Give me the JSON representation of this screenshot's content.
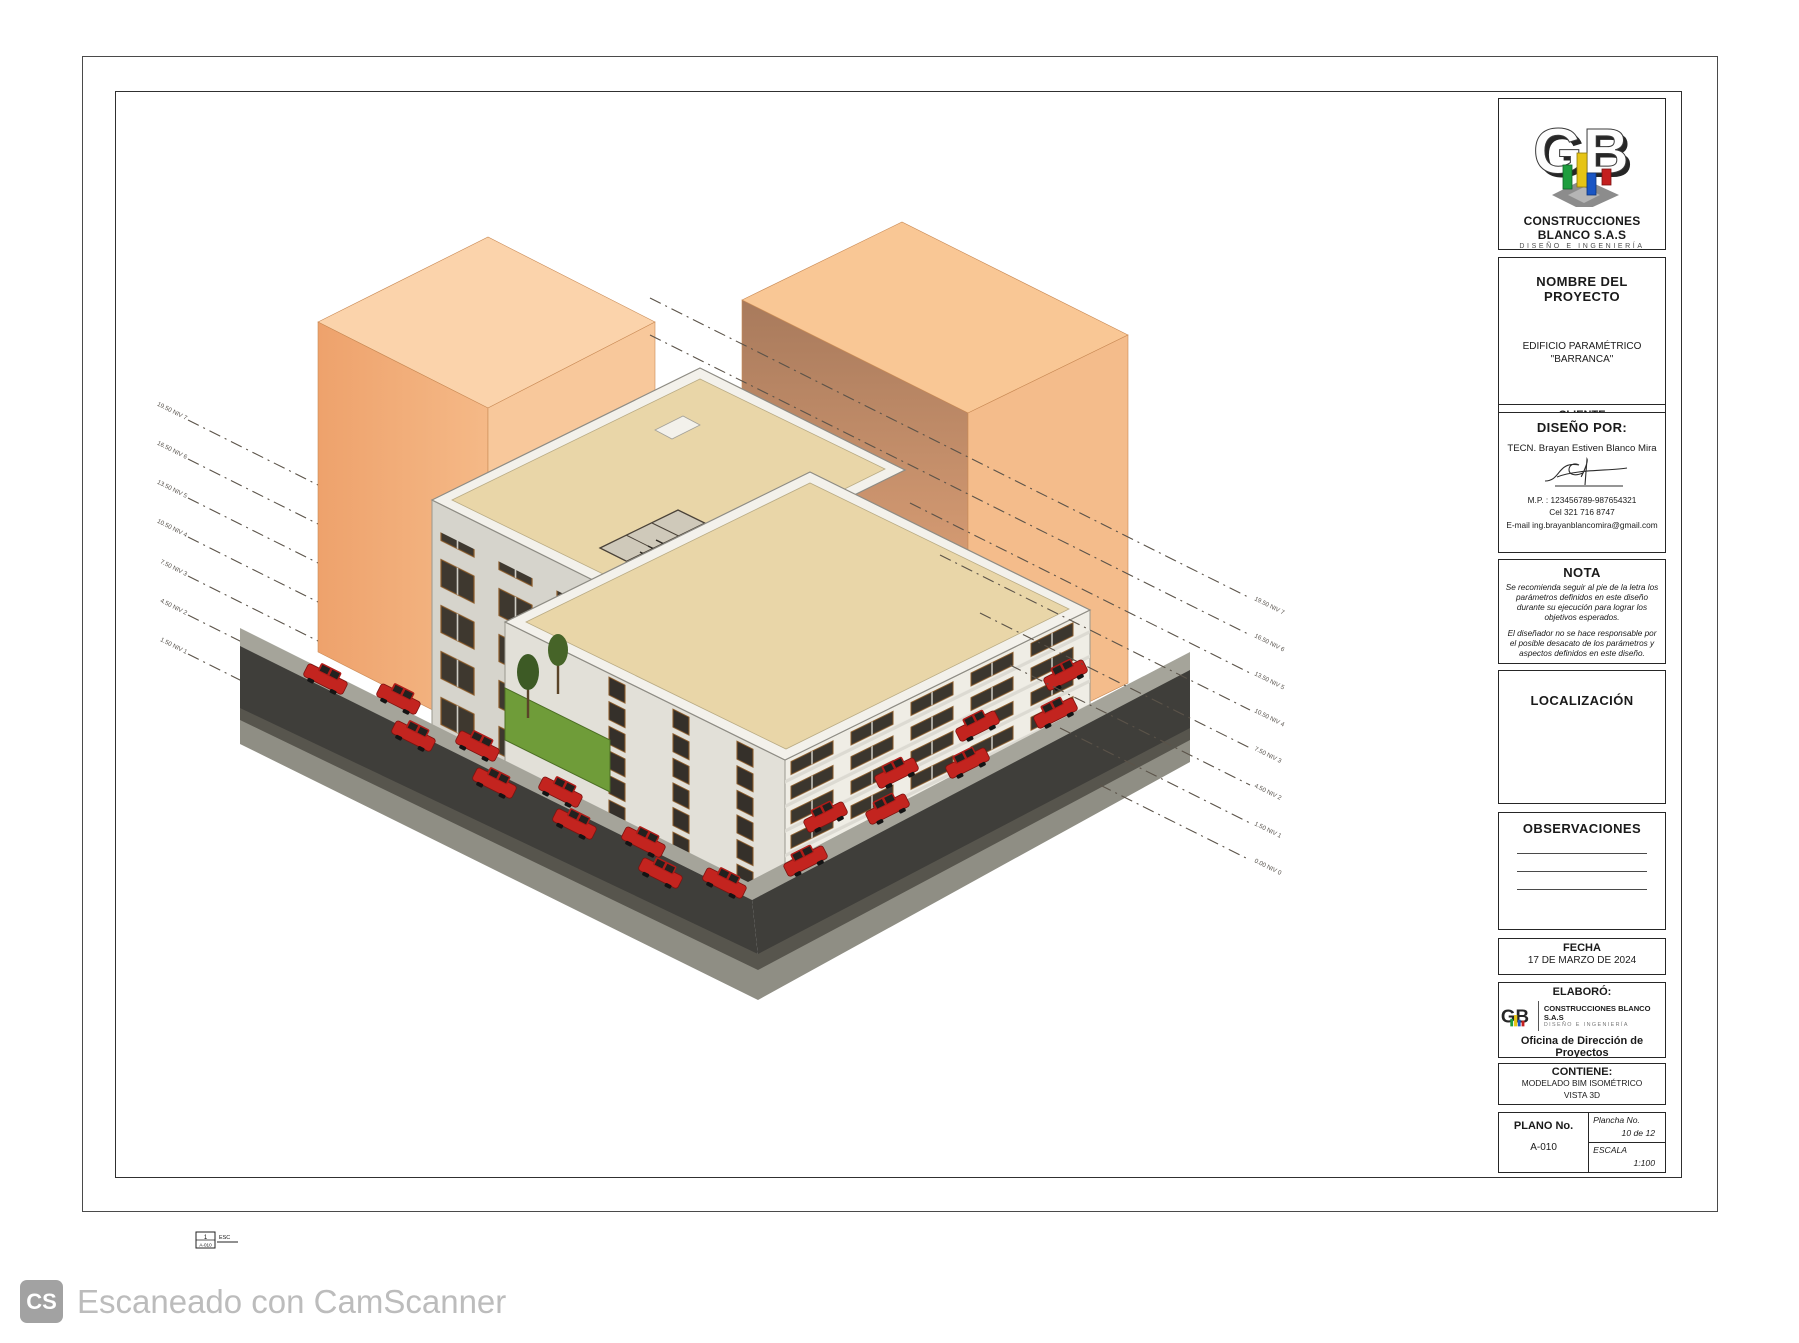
{
  "title_block": {
    "logo": {
      "company": "CONSTRUCCIONES BLANCO S.A.S",
      "tagline": "DISEÑO E INGENIERÍA"
    },
    "project": {
      "heading": "NOMBRE DEL PROYECTO",
      "name_line1": "EDIFICIO PARAMÉTRICO",
      "name_line2": "\"BARRANCA\""
    },
    "client": {
      "heading": "CLIENTE",
      "name": "DOMESTIKA INTERNACIONAL"
    },
    "designer": {
      "heading": "DISEÑO POR:",
      "name": "TECN. Brayan Estiven Blanco Mira",
      "mp": "M.P. : 123456789-987654321",
      "cel": "Cel  321 716 8747",
      "email": "E-mail  ing.brayanblancomira@gmail.com"
    },
    "nota": {
      "heading": "NOTA",
      "p1": "Se recomienda seguir al pie de la letra los parámetros definidos en este diseño durante su ejecución para lograr los objetivos esperados.",
      "p2": "El diseñador no se hace responsable por el posible desacato de los parámetros y aspectos definidos en este diseño."
    },
    "localizacion": {
      "heading": "LOCALIZACIÓN"
    },
    "observaciones": {
      "heading": "OBSERVACIONES"
    },
    "fecha": {
      "heading": "FECHA",
      "value": "17 DE MARZO DE 2024"
    },
    "elaboro": {
      "heading": "ELABORÓ:",
      "company": "CONSTRUCCIONES BLANCO S.A.S",
      "tagline": "DISEÑO E INGENIERÍA",
      "office": "Oficina de Dirección de Proyectos"
    },
    "contiene": {
      "heading": "CONTIENE:",
      "line1": "MODELADO BIM ISOMÉTRICO",
      "line2": "VISTA 3D"
    },
    "plano": {
      "heading": "PLANO No.",
      "value": "A-010",
      "plancha_label": "Plancha No.",
      "plancha_value": "10 de 12",
      "escala_label": "ESCALA",
      "escala_value": "1:100"
    }
  },
  "drawing": {
    "levels_left": [
      "19.50 NIV 7",
      "16.50 NIV 6",
      "13.50 NIV 5",
      "10.50 NIV 4",
      "7.50 NIV 3",
      "4.50 NIV 2",
      "1.50 NIV 1"
    ],
    "levels_right": [
      "19.50 NIV 7",
      "16.50 NIV 6",
      "13.50 NIV 5",
      "10.50 NIV 4",
      "7.50 NIV 3",
      "4.50 NIV 2",
      "1.50 NIV 1",
      "0.00 NIV 0"
    ],
    "view_tag": {
      "number": "1",
      "sheet": "A-010",
      "scale_label": "ESC"
    },
    "colors": {
      "context_orange": "#f3b181",
      "roof_tan": "#e9d6a8",
      "asphalt": "#3f3e3a",
      "car_red": "#c3241f",
      "grass": "#6f9c39",
      "parapet_white": "#f3f1eb"
    }
  },
  "watermark": {
    "badge": "CS",
    "text": "Escaneado con CamScanner"
  }
}
